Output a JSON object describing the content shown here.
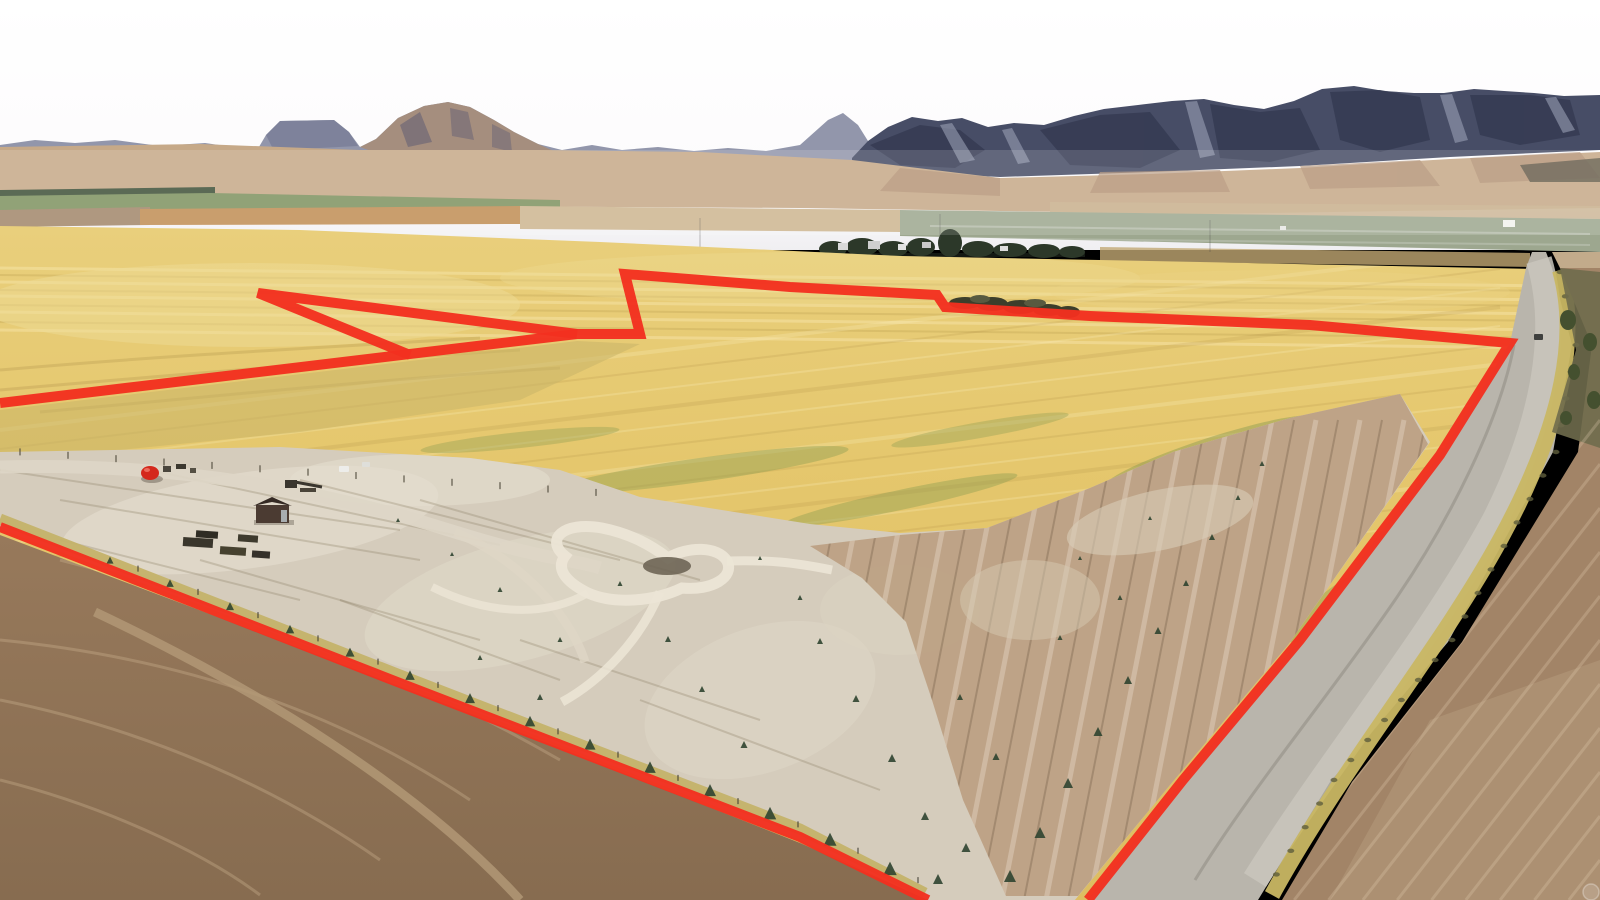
{
  "scene": {
    "description": "Aerial drone photograph of a large farmland parcel outlined with a red property boundary line",
    "sky": "overcast white sky",
    "backdrop": "desert mountain range with dark timbered peaks and tan foothills",
    "midground": "valley floor with cultivated strip fields and a distant farmstead windbreak",
    "parcel": "golden harvested grain field with graded dirt pad, looped sand path and young orchard rows",
    "east_edge": "gravel county road running along the right boundary",
    "southwest": "brown plowed field outside the boundary"
  },
  "colors": {
    "boundary_red": "#F3301F",
    "sky_top": "#FFFFFF",
    "sky_horizon": "#F1F0F2",
    "mountain_far": "#9296AB",
    "mountain_mesa": "#7A7F98",
    "mountain_brown": "#A58E7E",
    "mountain_near": "#474D66",
    "foothills": "#C6A988",
    "valley_green": "#7E9260",
    "valley_treeline": "#3F5138",
    "valley_orange": "#C08D54",
    "valley_graygreen": "#9DA78F",
    "field_gold": "#E5C76D",
    "dirt_pad": "#D5CCBC",
    "orchard_rows": "#BB9F81",
    "plowed_brown": "#8F7356",
    "road_gray": "#B9B5AC",
    "roadside_grass": "#C9B763",
    "east_field": "#A28467",
    "farm_treeline": "#2C3829",
    "tree_green": "#3C4E33",
    "shed_brown": "#4B3B32",
    "tank_red": "#D4281C"
  },
  "boundary": {
    "stroke_width": 10,
    "north_points": "0,403 577,334 640,334 625,274 790,287 937,295 945,307 1090,316 1310,325 1510,343 1440,455 1300,640 1183,780 1088,900",
    "notch_points": "410,355 258,293 577,334",
    "south_points": "0,527 400,683 800,837 928,900"
  },
  "landmarks": {
    "shed": "small wooden shed on graded pad",
    "red_tank": "round red tank",
    "soil_pits": "dark soil piles",
    "loop_path": "looping sand driveway with gravel island",
    "tree_clump": "windbreak tree row excluded by boundary notch",
    "farmstead": "distant farmstead with trucks and windbreak trees",
    "road": "gravel road with vehicle",
    "saplings": "young evergreen saplings along road and pad",
    "watermark": "faint circular watermark in lower right corner"
  }
}
